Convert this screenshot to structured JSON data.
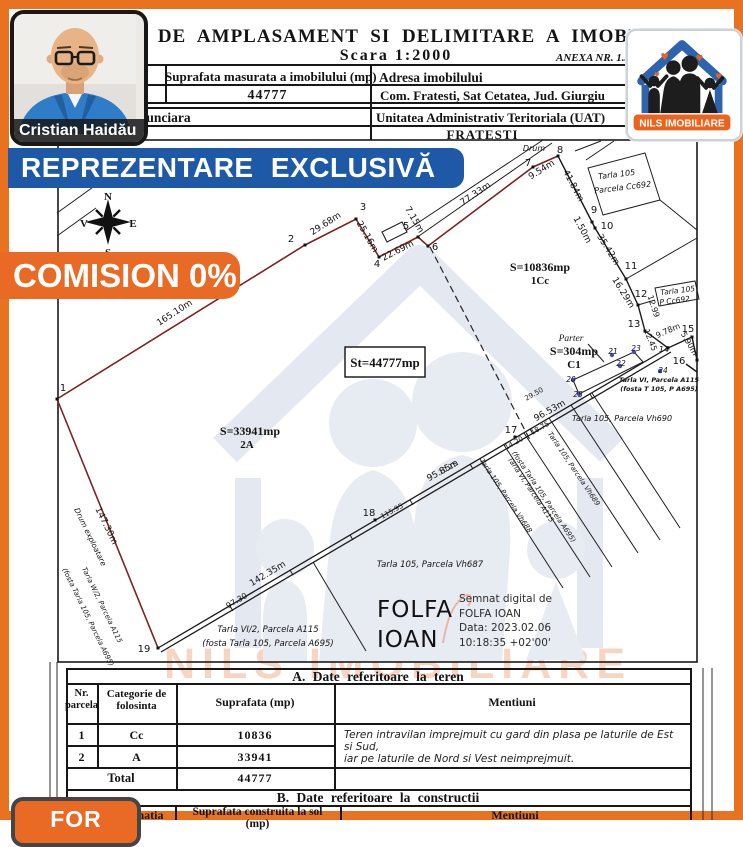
{
  "colors": {
    "frame": "#E8721F",
    "banner_blue": "#1E59A8",
    "banner_orange": "#E96A25",
    "boundary": "#7A2424",
    "logo_blue": "#2E63AD",
    "logo_orange": "#E8641F"
  },
  "agent": {
    "name": "Cristian Haidău"
  },
  "logo": {
    "name": "NILS IMOBILIARE",
    "heart": "♥"
  },
  "watermark": {
    "text": "NILS IMOBILIARE"
  },
  "banners": {
    "exclusive": "REPREZENTARE EXCLUSIVĂ",
    "commission": "COMISION 0%",
    "for_badge": "FOR"
  },
  "header": {
    "title": "PLAN DE AMPLASAMENT SI DELIMITARE A IMOBILULUI",
    "scale": "Scara 1:2000",
    "annex": "ANEXA NR. 1.35",
    "cadastral_label": "Nr. cadastral",
    "measured_area_label": "Suprafata masurata a imobilului (mp)",
    "measured_area_value": "44777",
    "address_label": "Adresa imobilului",
    "address_value": "Com. Fratesti, Sat Cetatea, Jud. Giurgiu",
    "land_book_label": "Cartea Funciara",
    "uat_label": "Unitatea Administrativ Teritoriala (UAT)",
    "uat_value": "FRATESTI"
  },
  "signature": {
    "name_line1": "FOLFA",
    "name_line2": "IOAN",
    "digital": [
      "Semnat digital de",
      "FOLFA IOAN",
      "Data: 2023.02.06",
      "10:18:35 +02'00'"
    ]
  },
  "table_a": {
    "title": "A. Date referitoare la teren",
    "col1_line1": "Nr.",
    "col1_line2": "parcela",
    "col2_line1": "Categorie de",
    "col2_line2": "folosinta",
    "col3": "Suprafata (mp)",
    "col4": "Mentiuni",
    "rows": [
      [
        "1",
        "Cc",
        "10836"
      ],
      [
        "2",
        "A",
        "33941"
      ]
    ],
    "total_label": "Total",
    "total_value": "44777",
    "mentions": [
      "Teren intravilan imprejmuit cu gard din plasa pe laturile de Est si Sud,",
      "iar pe laturile de Nord si Vest neimprejmuit."
    ]
  },
  "table_b": {
    "title": "B. Date referitoare la constructii",
    "col_dest": "Destinatia",
    "col_area_line1": "Suprafata construita la sol",
    "col_area_line2": "(mp)",
    "col_ment": "Mentiuni"
  },
  "map": {
    "compass": {
      "n": "N",
      "s": "S",
      "e": "E",
      "v": "V"
    },
    "labels": [
      {
        "t": "N",
        "x": 108,
        "y": 200,
        "s": 11,
        "b": 1,
        "f": "serif"
      },
      {
        "t": "S",
        "x": 108,
        "y": 256,
        "s": 11,
        "b": 1,
        "f": "serif"
      },
      {
        "t": "V",
        "x": 84,
        "y": 227,
        "s": 11,
        "b": 1,
        "f": "serif"
      },
      {
        "t": "E",
        "x": 133,
        "y": 227,
        "s": 11,
        "b": 1,
        "f": "serif"
      },
      {
        "t": "165.10m",
        "x": 176,
        "y": 315,
        "r": -33
      },
      {
        "t": "29.68m",
        "x": 327,
        "y": 226,
        "r": -33
      },
      {
        "t": "25.16m",
        "x": 365,
        "y": 238,
        "r": 60
      },
      {
        "t": "22.69m",
        "x": 399,
        "y": 253,
        "r": -27
      },
      {
        "t": "7.15m",
        "x": 412,
        "y": 221,
        "r": 60
      },
      {
        "t": "77.33m",
        "x": 477,
        "y": 196,
        "r": -34
      },
      {
        "t": "9.54m",
        "x": 543,
        "y": 172,
        "r": -32
      },
      {
        "t": "Drum",
        "x": 534,
        "y": 151,
        "s": 8,
        "i": 1
      },
      {
        "t": "41.84m",
        "x": 571,
        "y": 187,
        "r": 62
      },
      {
        "t": "1.50m",
        "x": 580,
        "y": 231,
        "r": 62
      },
      {
        "t": "35.42m",
        "x": 606,
        "y": 251,
        "r": 58
      },
      {
        "t": "16.29m",
        "x": 621,
        "y": 294,
        "r": 58
      },
      {
        "t": "12.99",
        "x": 651,
        "y": 307,
        "r": 72,
        "s": 8
      },
      {
        "t": "12.45",
        "x": 648,
        "y": 341,
        "r": 68,
        "s": 8
      },
      {
        "t": "9.78m",
        "x": 669,
        "y": 333,
        "r": -24,
        "s": 8
      },
      {
        "t": "5.90m",
        "x": 687,
        "y": 345,
        "r": 60,
        "s": 8
      },
      {
        "t": "96.53m",
        "x": 551,
        "y": 413,
        "r": -29
      },
      {
        "t": "95.85m",
        "x": 444,
        "y": 473,
        "r": -29
      },
      {
        "t": "142.35m",
        "x": 269,
        "y": 576,
        "r": -31
      },
      {
        "t": "97.30",
        "x": 238,
        "y": 603,
        "r": -31,
        "s": 8
      },
      {
        "t": "147.30m",
        "x": 104,
        "y": 527,
        "r": 64
      },
      {
        "t": "Drum exploatare",
        "x": 88,
        "y": 538,
        "r": 64,
        "s": 7.5,
        "i": 1
      },
      {
        "t": "115.95",
        "x": 393,
        "y": 513,
        "r": -29,
        "s": 7
      },
      {
        "t": "29.50",
        "x": 535,
        "y": 396,
        "r": -29,
        "s": 7
      },
      {
        "t": "18.75",
        "x": 541,
        "y": 430,
        "r": -29,
        "s": 7
      },
      {
        "t": "14.20",
        "x": 515,
        "y": 445,
        "r": -29,
        "s": 7
      },
      {
        "t": "10.25",
        "x": 449,
        "y": 470,
        "r": -29,
        "s": 7
      },
      {
        "t": "1",
        "x": 63,
        "y": 391,
        "s": 10
      },
      {
        "t": "2",
        "x": 291,
        "y": 242,
        "s": 10
      },
      {
        "t": "3",
        "x": 363,
        "y": 210,
        "s": 10
      },
      {
        "t": "4",
        "x": 377,
        "y": 267,
        "s": 10
      },
      {
        "t": "5",
        "x": 406,
        "y": 229,
        "s": 10
      },
      {
        "t": "6",
        "x": 435,
        "y": 250,
        "s": 10
      },
      {
        "t": "7",
        "x": 528,
        "y": 166,
        "s": 10
      },
      {
        "t": "8",
        "x": 560,
        "y": 153,
        "s": 10
      },
      {
        "t": "9",
        "x": 594,
        "y": 213,
        "s": 10
      },
      {
        "t": "10",
        "x": 607,
        "y": 229,
        "s": 10
      },
      {
        "t": "11",
        "x": 631,
        "y": 269,
        "s": 10
      },
      {
        "t": "12",
        "x": 641,
        "y": 297,
        "s": 10
      },
      {
        "t": "13",
        "x": 634,
        "y": 327,
        "s": 10
      },
      {
        "t": "14",
        "x": 664,
        "y": 352,
        "s": 8,
        "i": 1
      },
      {
        "t": "15",
        "x": 688,
        "y": 332,
        "s": 10
      },
      {
        "t": "16",
        "x": 679,
        "y": 364,
        "s": 10
      },
      {
        "t": "17",
        "x": 511,
        "y": 433,
        "s": 10
      },
      {
        "t": "18",
        "x": 369,
        "y": 516,
        "s": 10
      },
      {
        "t": "19",
        "x": 144,
        "y": 652,
        "s": 10
      },
      {
        "t": "20",
        "x": 571,
        "y": 382,
        "s": 7.5,
        "i": 1
      },
      {
        "t": "21",
        "x": 613,
        "y": 354,
        "s": 7.5,
        "i": 1
      },
      {
        "t": "22",
        "x": 621,
        "y": 366,
        "s": 7.5,
        "i": 1
      },
      {
        "t": "23",
        "x": 636,
        "y": 351,
        "s": 7.5,
        "i": 1
      },
      {
        "t": "24",
        "x": 663,
        "y": 373,
        "s": 7.5,
        "i": 1
      },
      {
        "t": "25",
        "x": 578,
        "y": 397,
        "s": 7.5,
        "i": 1
      },
      {
        "t": "S=10836mp",
        "x": 540,
        "y": 271,
        "s": 12,
        "b": 1,
        "f": "serif"
      },
      {
        "t": "1Cc",
        "x": 540,
        "y": 284,
        "s": 11,
        "b": 1,
        "f": "serif"
      },
      {
        "t": "St=44777mp",
        "x": 385,
        "y": 367,
        "s": 13,
        "b": 1,
        "f": "serif"
      },
      {
        "t": "S=33941mp",
        "x": 250,
        "y": 435,
        "s": 12,
        "b": 1,
        "f": "serif"
      },
      {
        "t": "2A",
        "x": 247,
        "y": 448,
        "s": 11,
        "b": 1,
        "f": "serif"
      },
      {
        "t": "Parter",
        "x": 571,
        "y": 341,
        "s": 9.5,
        "i": 1,
        "f": "serif"
      },
      {
        "t": "S=304mp",
        "x": 574,
        "y": 355,
        "s": 12,
        "b": 1,
        "f": "serif"
      },
      {
        "t": "C1",
        "x": 574,
        "y": 368,
        "s": 11,
        "b": 1,
        "f": "serif"
      },
      {
        "t": "Tarla 105",
        "x": 617,
        "y": 177,
        "r": -7,
        "s": 8,
        "i": 1
      },
      {
        "t": "Parcela Cc692",
        "x": 623,
        "y": 190,
        "r": -7,
        "s": 8,
        "i": 1
      },
      {
        "t": "Tarla 105",
        "x": 678,
        "y": 293,
        "r": -7,
        "s": 7.5,
        "i": 1
      },
      {
        "t": "P Cc692",
        "x": 675,
        "y": 303,
        "r": -7,
        "s": 7.5,
        "i": 1
      },
      {
        "t": "Tarla VI, Parcela A115",
        "x": 659,
        "y": 382,
        "s": 6.5,
        "i": 1,
        "b": 1
      },
      {
        "t": "(fosta T 105, P A695)",
        "x": 659,
        "y": 391,
        "s": 6.5,
        "i": 1,
        "b": 1
      },
      {
        "t": "Tarla 105, Parcela Vh690",
        "x": 622,
        "y": 421,
        "s": 8,
        "i": 1
      },
      {
        "t": "Tarla 105, Parcela Vh687",
        "x": 430,
        "y": 567,
        "s": 8.5,
        "i": 1
      },
      {
        "t": "Tarla VI/2, Parcela A115",
        "x": 268,
        "y": 632,
        "s": 8.5,
        "i": 1
      },
      {
        "t": "(fosta Tarla 105, Parcela A695)",
        "x": 268,
        "y": 646,
        "s": 8.5,
        "i": 1
      },
      {
        "t": "Tarla W/2, Parcela A115",
        "x": 100,
        "y": 606,
        "r": 64,
        "s": 7,
        "i": 1
      },
      {
        "t": "(fosta Tarla 105, Parcela A695)",
        "x": 86,
        "y": 618,
        "r": 64,
        "s": 7,
        "i": 1
      },
      {
        "t": "Tarla 105, Parcela Vh688",
        "x": 504,
        "y": 497,
        "r": 56,
        "s": 7,
        "i": 1
      },
      {
        "t": "Tarla VI, Parcela A115",
        "x": 529,
        "y": 491,
        "r": 56,
        "s": 7,
        "i": 1
      },
      {
        "t": "(fosta Tarla 105, Parcela A695)",
        "x": 542,
        "y": 498,
        "r": 56,
        "s": 7,
        "i": 1
      },
      {
        "t": "Tarla 105, Parcela Vh689",
        "x": 572,
        "y": 470,
        "r": 56,
        "s": 7,
        "i": 1
      }
    ],
    "points": [
      [
        57,
        399
      ],
      [
        305,
        245
      ],
      [
        356,
        219
      ],
      [
        379,
        257
      ],
      [
        418,
        237
      ],
      [
        428,
        246
      ],
      [
        533,
        167
      ],
      [
        558,
        156
      ],
      [
        592,
        222
      ],
      [
        595,
        228
      ],
      [
        626,
        279
      ],
      [
        638,
        305
      ],
      [
        645,
        331
      ],
      [
        668,
        348
      ],
      [
        692,
        337
      ],
      [
        697,
        360
      ],
      [
        515,
        437
      ],
      [
        375,
        520
      ],
      [
        158,
        648
      ]
    ],
    "blue_points": [
      [
        573,
        380
      ],
      [
        612,
        355
      ],
      [
        620,
        366
      ],
      [
        634,
        352
      ],
      [
        660,
        371
      ],
      [
        579,
        394
      ]
    ]
  }
}
